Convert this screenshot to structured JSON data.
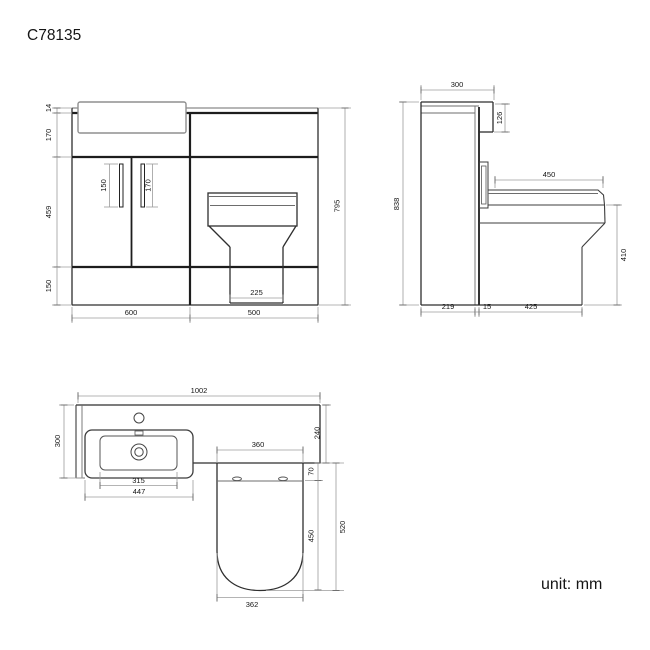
{
  "title": "C78135",
  "unit_label": "unit: mm",
  "front_view": {
    "worktop_thickness": "14",
    "worktop_to_doors": "170",
    "door_height": "459",
    "plinth_height": "150",
    "left_handle": "150",
    "right_handle": "170",
    "overall_height": "795",
    "pedestal_width": "225",
    "vanity_width": "600",
    "wc_unit_width": "500"
  },
  "side_view": {
    "depth": "300",
    "worktop_drop": "126",
    "overall_height": "838",
    "seat_depth": "450",
    "seat_height": "410",
    "cabinet_depth": "219",
    "gap": "15",
    "pan_projection": "425"
  },
  "plan_view": {
    "overall_width": "1002",
    "basin_depth": "300",
    "worktop_depth": "240",
    "basin_bowl_width": "315",
    "basin_width": "447",
    "pan_width": "360",
    "seat_inset": "70",
    "pan_length": "450",
    "pan_total_depth": "520",
    "pan_front_width": "362"
  }
}
